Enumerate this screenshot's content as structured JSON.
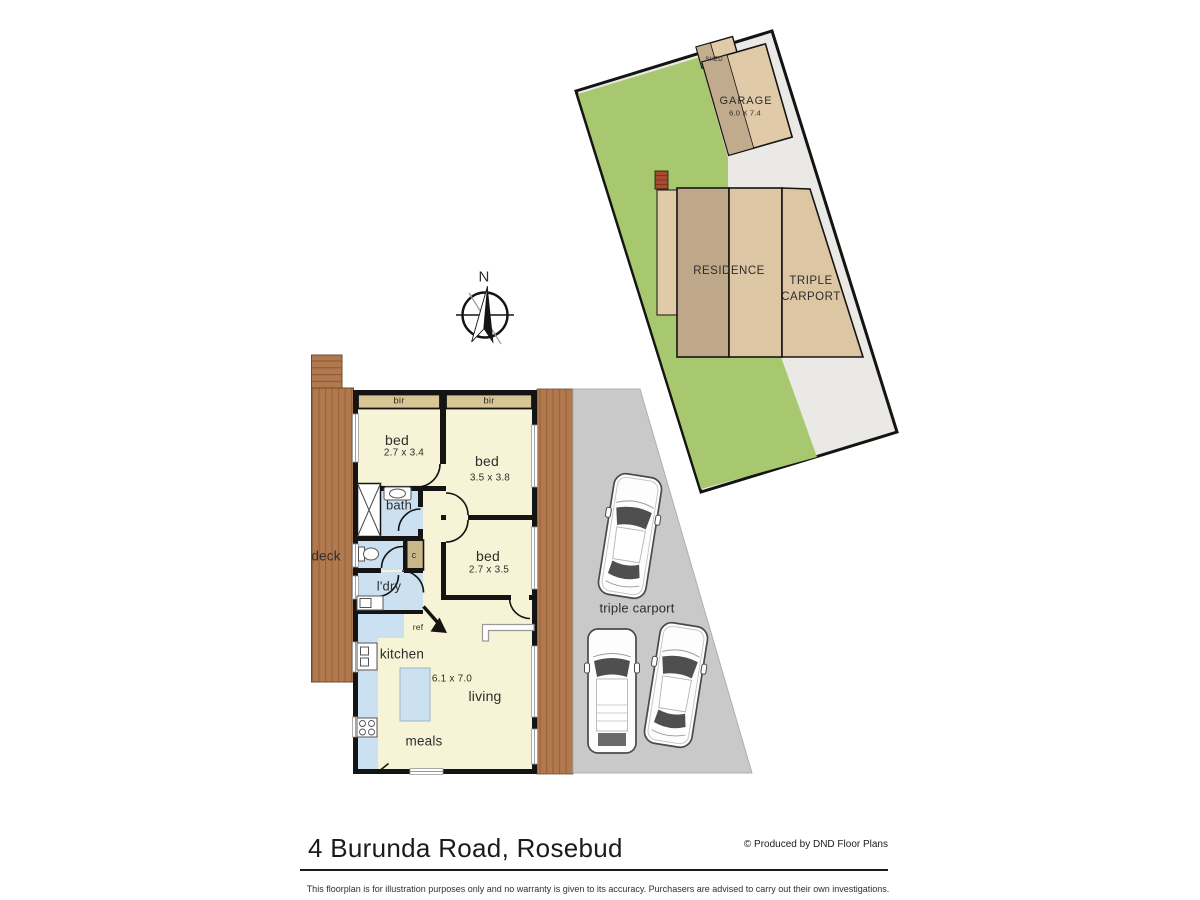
{
  "site_plan": {
    "shed_label": "SHED",
    "garage_label": "GARAGE",
    "garage_dim": "6.0 X 7.4",
    "residence_label": "RESIDENCE",
    "carport_label_line1": "TRIPLE",
    "carport_label_line2": "CARPORT"
  },
  "compass": {
    "north_label": "N"
  },
  "floor_plan": {
    "bir_left_label": "bir",
    "bir_right_label": "bir",
    "bed1_label": "bed",
    "bed1_dim": "2.7 x 3.4",
    "bed2_label": "bed",
    "bed2_dim": "3.5 x 3.8",
    "bed3_label": "bed",
    "bed3_dim": "2.7 x 3.5",
    "bath_label": "bath",
    "cupboard_label": "c",
    "laundry_label": "l'dry",
    "deck_label": "deck",
    "fridge_label": "ref",
    "kitchen_label": "kitchen",
    "living_label": "living",
    "living_dim": "6.1 x 7.0",
    "meals_label": "meals",
    "carport_label": "triple carport"
  },
  "footer": {
    "address": "4 Burunda Road, Rosebud",
    "credit": "© Produced by DND Floor Plans",
    "disclaimer": "This floorplan is for illustration purposes only and no warranty is given to its accuracy. Purchasers are advised to carry out their own investigations."
  },
  "colors": {
    "lawn": "#a7c86e",
    "site_paving": "#eae9e5",
    "building_tan_light": "#e0caa7",
    "building_tan_dark": "#c2ab8c",
    "residence_dark": "#bfa88a",
    "residence_light": "#dcc6a3",
    "room_cream": "#f7f3d6",
    "wet_blue": "#cbe1f1",
    "robe_tan": "#d8c794",
    "deck_brown": "#b3794e",
    "carport_grey": "#c9c9c9",
    "wall": "#141414"
  }
}
